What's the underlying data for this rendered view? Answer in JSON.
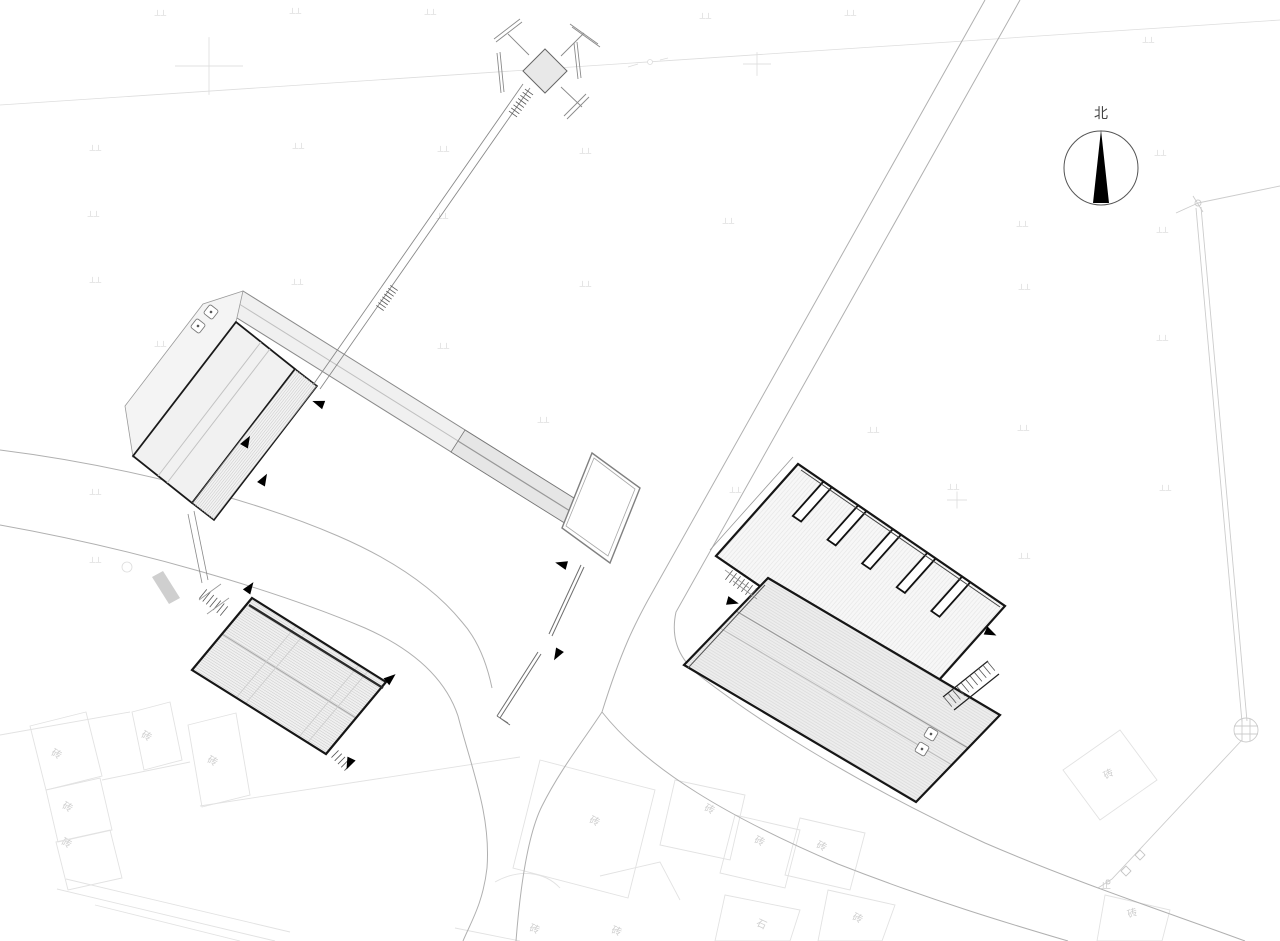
{
  "north": {
    "label": "北"
  },
  "colors": {
    "building_outline": "#161616",
    "road_line": "#b0b0b0",
    "faint_line": "#e2e2e2",
    "roof_fill": "#f0f0f0",
    "needle": "#000000"
  },
  "faint_labels": [
    {
      "text": "砖",
      "x": 57,
      "y": 753,
      "r": 28
    },
    {
      "text": "砖",
      "x": 68,
      "y": 806,
      "r": 28
    },
    {
      "text": "砖",
      "x": 67,
      "y": 842,
      "r": 28
    },
    {
      "text": "砖",
      "x": 147,
      "y": 735,
      "r": 28
    },
    {
      "text": "砖",
      "x": 213,
      "y": 760,
      "r": 28
    },
    {
      "text": "砖",
      "x": 595,
      "y": 820,
      "r": 25
    },
    {
      "text": "砖",
      "x": 710,
      "y": 808,
      "r": 25
    },
    {
      "text": "砖",
      "x": 760,
      "y": 840,
      "r": 25
    },
    {
      "text": "砖",
      "x": 822,
      "y": 845,
      "r": 25
    },
    {
      "text": "砖",
      "x": 858,
      "y": 917,
      "r": 25
    },
    {
      "text": "石",
      "x": 762,
      "y": 923,
      "r": 25
    },
    {
      "text": "砖",
      "x": 1108,
      "y": 773,
      "r": -30
    },
    {
      "text": "砖",
      "x": 1132,
      "y": 912,
      "r": -20
    },
    {
      "text": "砖",
      "x": 535,
      "y": 928,
      "r": 20
    },
    {
      "text": "砖",
      "x": 617,
      "y": 930,
      "r": 20
    },
    {
      "text": "止",
      "x": 1106,
      "y": 884,
      "r": 0
    }
  ],
  "grass_marks": [
    [
      160,
      13
    ],
    [
      295,
      11
    ],
    [
      430,
      12
    ],
    [
      705,
      16
    ],
    [
      850,
      13
    ],
    [
      1148,
      40
    ],
    [
      95,
      148
    ],
    [
      298,
      146
    ],
    [
      443,
      149
    ],
    [
      585,
      151
    ],
    [
      1160,
      153
    ],
    [
      93,
      214
    ],
    [
      442,
      216
    ],
    [
      728,
      221
    ],
    [
      1022,
      224
    ],
    [
      1162,
      230
    ],
    [
      95,
      280
    ],
    [
      297,
      282
    ],
    [
      585,
      284
    ],
    [
      1024,
      287
    ],
    [
      160,
      344
    ],
    [
      443,
      346
    ],
    [
      1162,
      338
    ],
    [
      543,
      420
    ],
    [
      873,
      430
    ],
    [
      1023,
      428
    ],
    [
      95,
      492
    ],
    [
      735,
      490
    ],
    [
      953,
      487
    ],
    [
      1165,
      488
    ],
    [
      95,
      560
    ],
    [
      1024,
      556
    ]
  ],
  "crosses": [
    {
      "x": 209,
      "y": 66,
      "s": 34
    },
    {
      "x": 757,
      "y": 64,
      "s": 14
    },
    {
      "x": 957,
      "y": 500,
      "s": 10
    }
  ],
  "entrance_arrows": [
    {
      "x": 247,
      "y": 441,
      "r": -60
    },
    {
      "x": 264,
      "y": 479,
      "r": -60
    },
    {
      "x": 318,
      "y": 403,
      "r": 200
    },
    {
      "x": 561,
      "y": 564,
      "r": 195
    },
    {
      "x": 557,
      "y": 655,
      "r": 120
    },
    {
      "x": 250,
      "y": 587,
      "r": -55
    },
    {
      "x": 391,
      "y": 678,
      "r": -40
    },
    {
      "x": 349,
      "y": 764,
      "r": 115
    },
    {
      "x": 733,
      "y": 602,
      "r": 15
    },
    {
      "x": 991,
      "y": 633,
      "r": 25
    }
  ],
  "utility_boxes": [
    {
      "x": 198,
      "y": 326,
      "r": 38
    },
    {
      "x": 211,
      "y": 312,
      "r": 38
    },
    {
      "x": 922,
      "y": 749,
      "r": 31
    },
    {
      "x": 931,
      "y": 734,
      "r": 31
    }
  ]
}
